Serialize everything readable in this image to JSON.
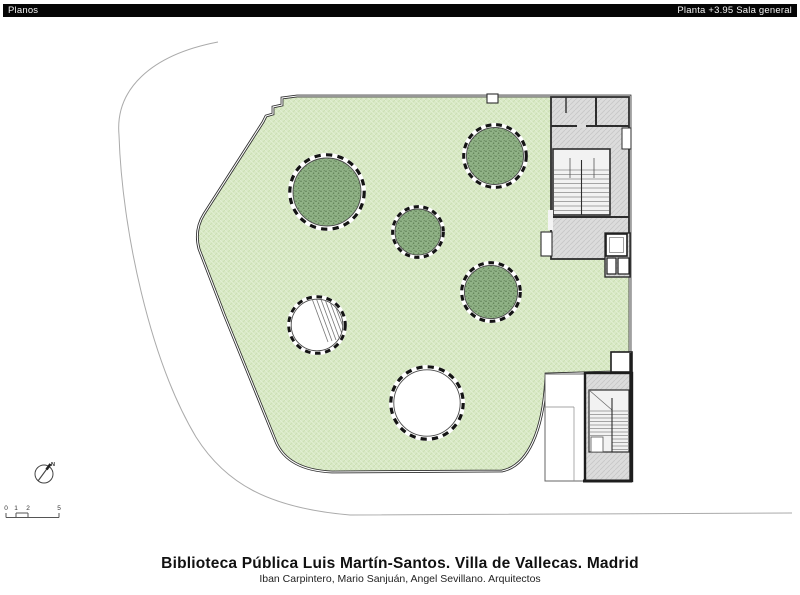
{
  "header": {
    "left": "Planos",
    "right": "Planta +3.95 Sala general"
  },
  "plan": {
    "north_arrow_label": "N",
    "scale_bar": {
      "labels": [
        "0",
        "1",
        "2",
        "5"
      ]
    },
    "legend": {
      "tree_courtyards": 4,
      "skylight_openings": 2
    }
  },
  "footer": {
    "title": "Biblioteca Pública Luis Martín-Santos. Villa de Vallecas. Madrid",
    "subtitle": "Iban Carpintero, Mario Sanjuán, Angel Sevillano. Arquitectos"
  },
  "colors": {
    "header_bg": "#050505",
    "header_text": "#f5f5f5",
    "lawn_green": "#d9e9c6",
    "tree_green": "#90b286",
    "core_gray": "#dcdcdc",
    "wall_dark": "#2d2d2d",
    "site_line_gray": "#aaaaaa"
  }
}
